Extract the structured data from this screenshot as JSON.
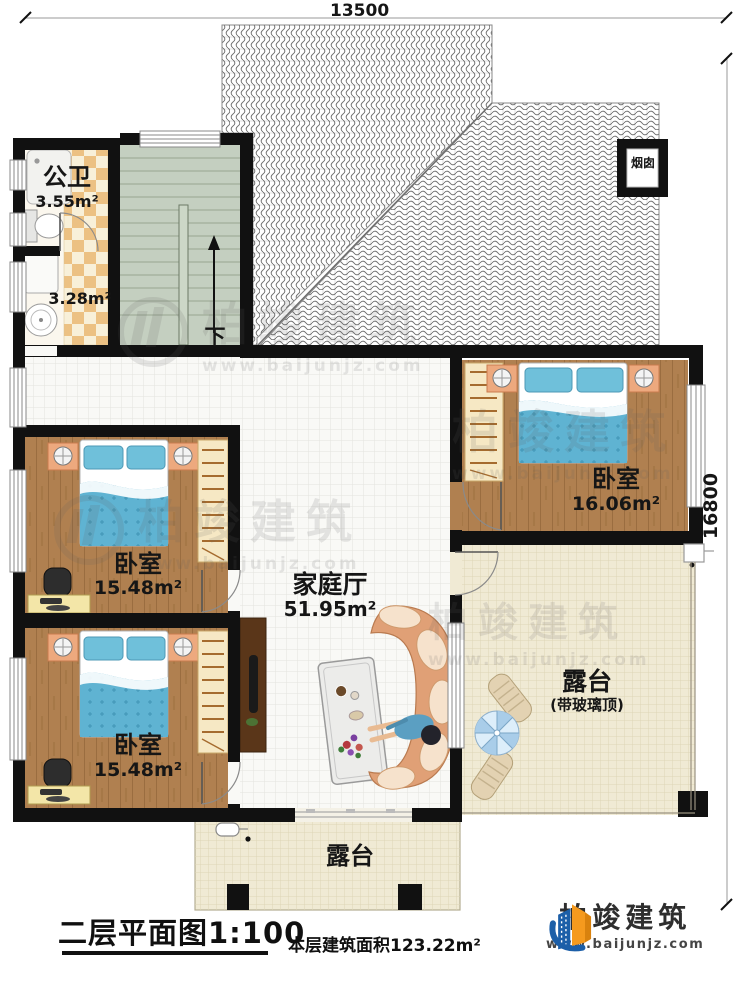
{
  "dimensions": {
    "top": "13500",
    "right": "16800"
  },
  "rooms": {
    "public_bath": {
      "label": "公卫",
      "area": "3.55m²"
    },
    "wash_area": {
      "area": "3.28m²"
    },
    "stairs": {
      "down_label": "下"
    },
    "chimney": {
      "label": "烟囱"
    },
    "family_hall": {
      "label": "家庭厅",
      "area": "51.95m²"
    },
    "bedroom_right": {
      "label": "卧室",
      "area": "16.06m²"
    },
    "bedroom_mid": {
      "label": "卧室",
      "area": "15.48m²"
    },
    "bedroom_bottom": {
      "label": "卧室",
      "area": "15.48m²"
    },
    "terrace_right": {
      "label": "露台",
      "note": "(带玻璃顶)"
    },
    "terrace_bottom": {
      "label": "露台"
    }
  },
  "caption": {
    "plan_title": "二层平面图1:100",
    "floor_area_note": "本层建筑面积123.22m²"
  },
  "brand": {
    "name": "柏竣建筑",
    "website": "www.baijunjz.com"
  },
  "watermark": {
    "name": "柏竣建筑",
    "website": "www.baijunjz.com"
  },
  "colors": {
    "wall": "#111111",
    "wood_floor": "#b08050",
    "bed_blue": "#62b7d6",
    "nightstand": "#eda97e",
    "stair_floor": "#c4cfc0",
    "checker_tan": "#ecc183",
    "terrace_floor": "#f0ead4",
    "sofa": "#e0a076",
    "brand_blue": "#1c5fa8",
    "brand_orange": "#f59a1e"
  }
}
